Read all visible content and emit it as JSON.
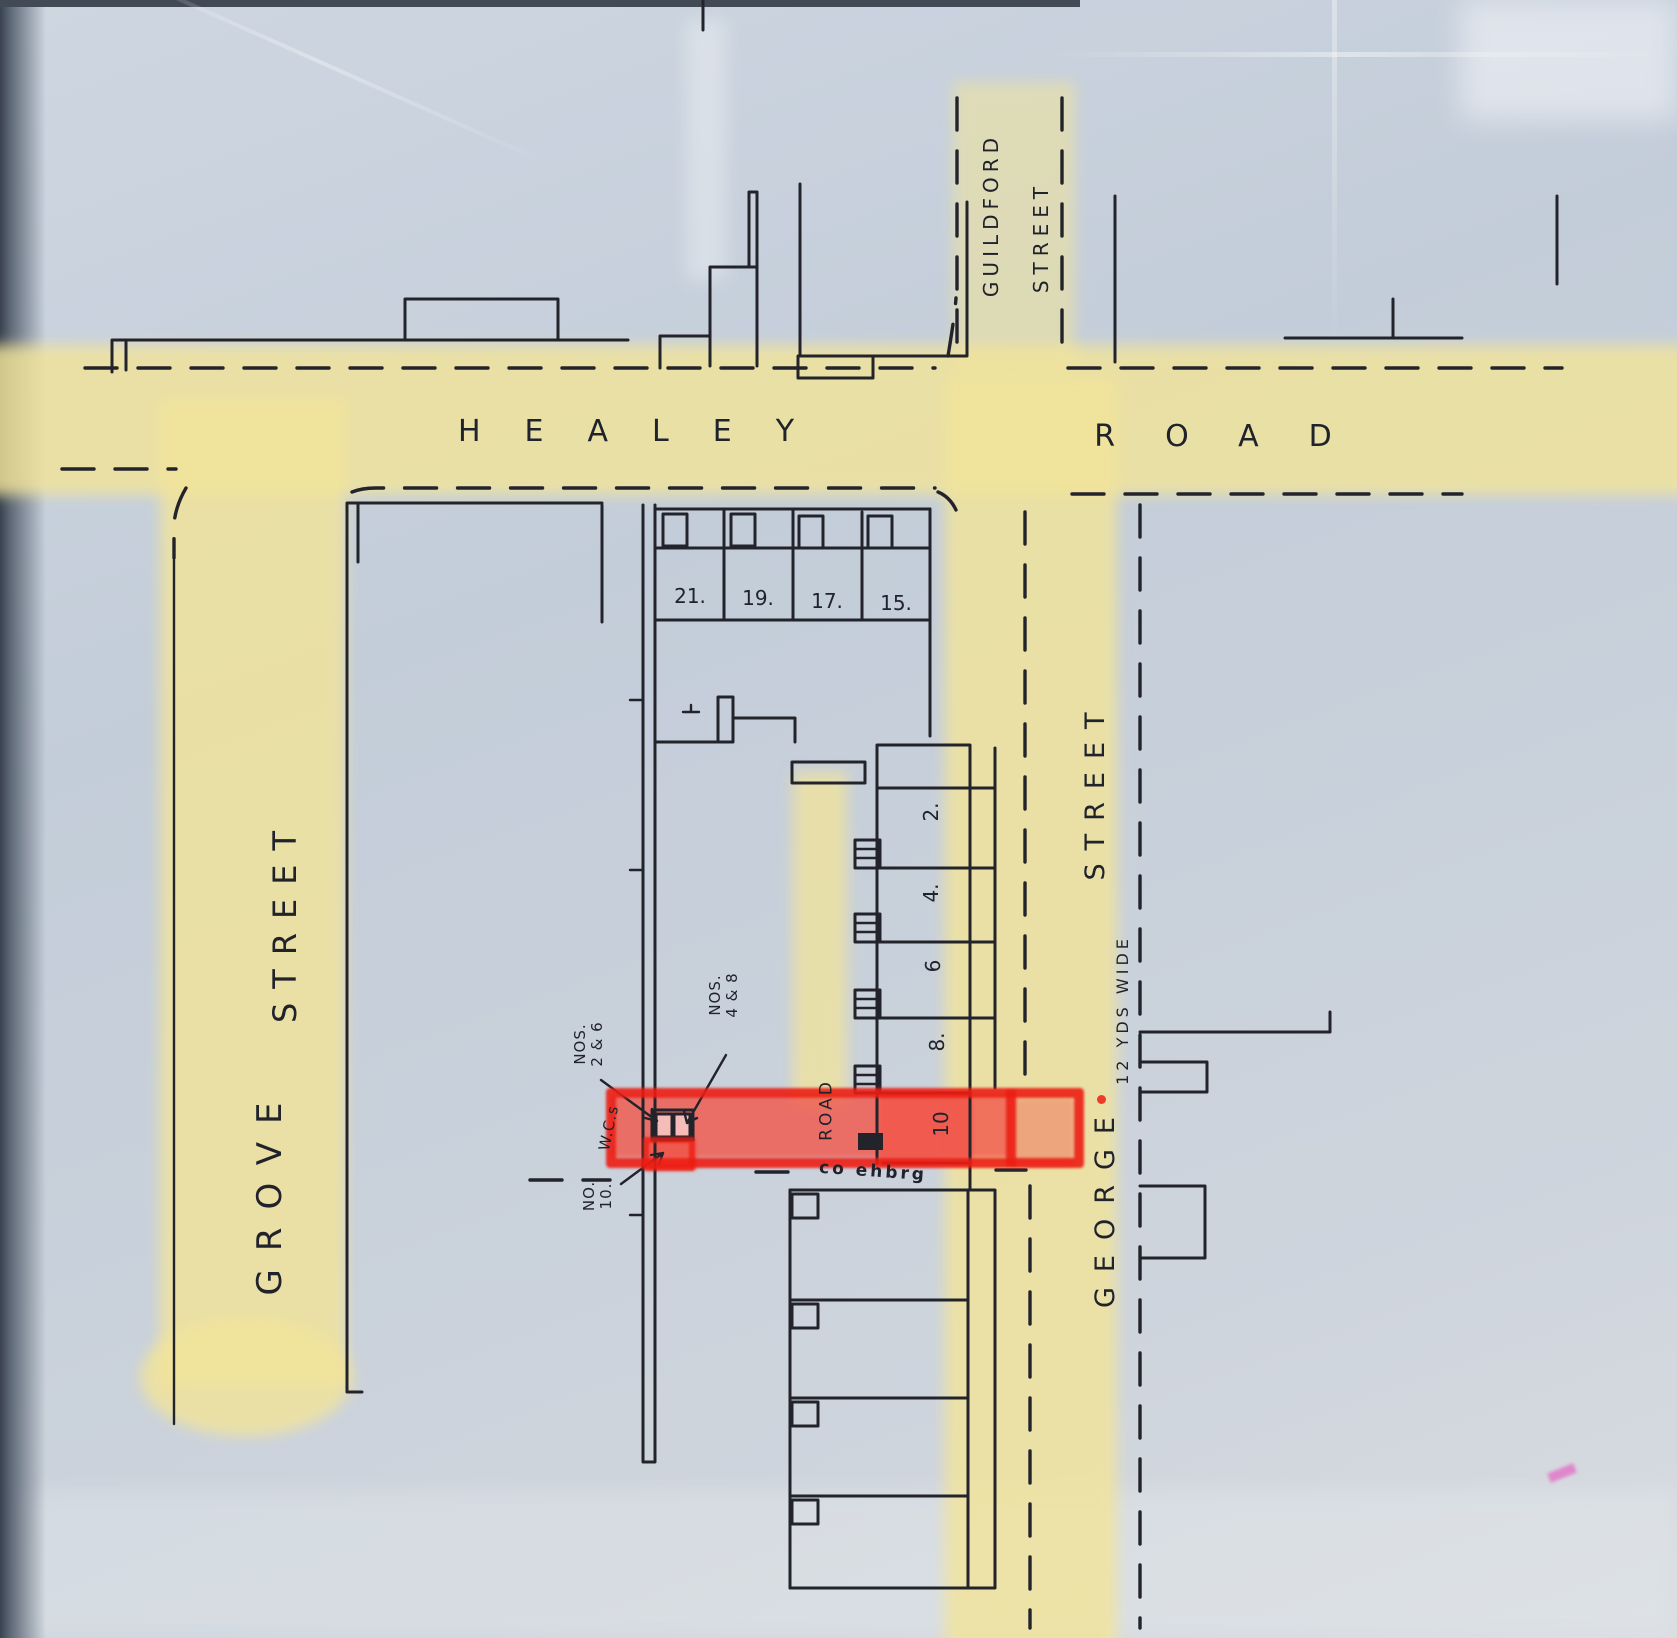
{
  "streets": {
    "healey": {
      "left_word": "HEALEY",
      "right_word": "ROAD"
    },
    "guildford": {
      "word1": "GUILDFORD",
      "word2": "STREET"
    },
    "grove": {
      "word1": "GROVE",
      "word2": "STREET"
    },
    "george": {
      "word1": "GEORGE",
      "word2": "STREET",
      "width_note": "12 YDS WIDE"
    },
    "back_lane": {
      "word": "ROAD",
      "upside_down_note": "co ehbrg"
    }
  },
  "house_numbers": {
    "healey_row": [
      "21.",
      "19.",
      "17.",
      "15."
    ],
    "george_column": [
      "2.",
      "4.",
      "6",
      "8.",
      "10"
    ]
  },
  "annotations": {
    "nos_2_6_line1": "NOS.",
    "nos_2_6_line2": "2 & 6",
    "nos_4_8_line1": "NOS.",
    "nos_4_8_line2": "4 & 8",
    "wcs": "W.C.s",
    "no_10_line1": "NO.",
    "no_10_line2": "10."
  },
  "colors": {
    "paper": "#c6cfda",
    "highlight_yellow": "#f2e49a",
    "highlight_red_outline": "#ec1d13",
    "highlight_red_fill": "#f2564a",
    "ink": "#23232b",
    "pink_mark": "#e473c8"
  }
}
